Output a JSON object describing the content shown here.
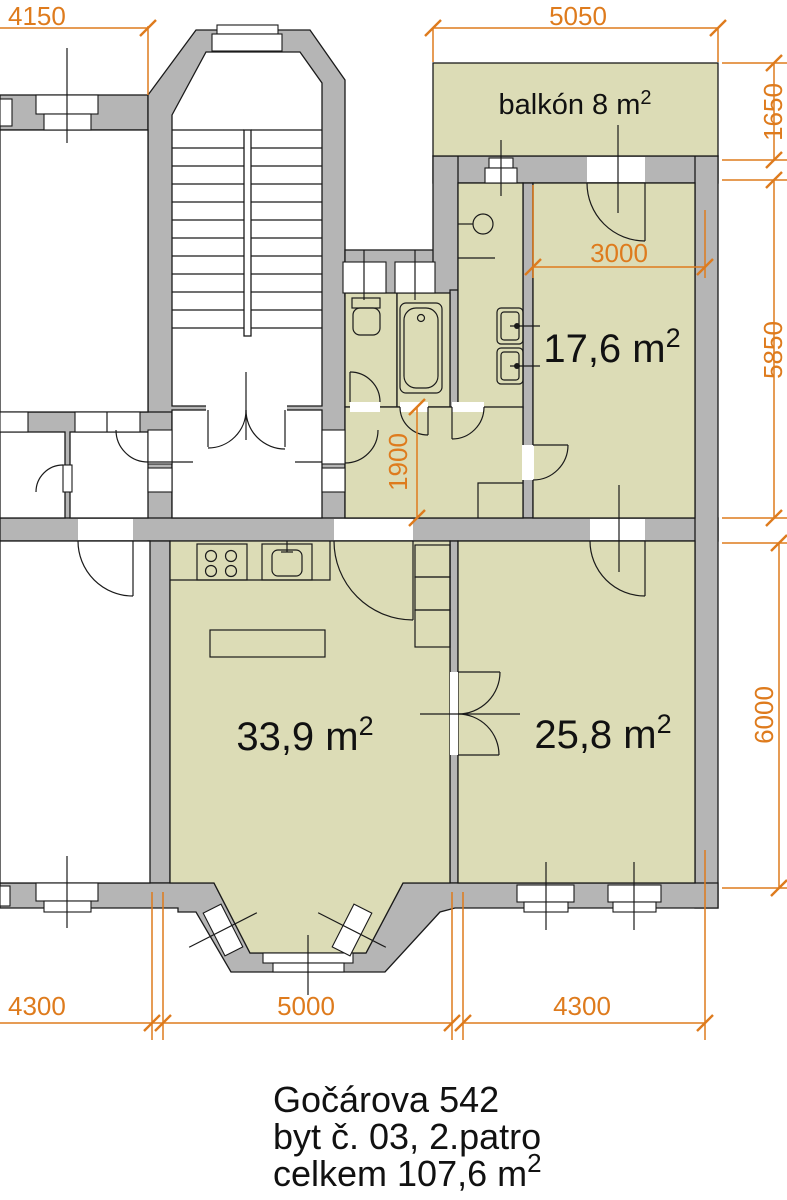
{
  "plan": {
    "type": "apartment-floor-plan",
    "labels": {
      "balcony": {
        "text": "balkón 8 m",
        "sup": "2"
      },
      "room_176": {
        "text": "17,6 m",
        "sup": "2"
      },
      "room_339": {
        "text": "33,9 m",
        "sup": "2"
      },
      "room_258": {
        "text": "25,8 m",
        "sup": "2"
      }
    },
    "dimensions": {
      "top_left": "4150",
      "top": "5050",
      "balcony_depth": "1650",
      "upper_section_height": "5850",
      "hall_height": "1900",
      "room_176_width": "3000",
      "lower_section_height": "6000",
      "bottom_left": "4300",
      "bottom_center": "5000",
      "bottom_right": "4300"
    },
    "title": {
      "line1": "Gočárova 542",
      "line2": "byt č. 03, 2.patro",
      "line3": "celkem 107,6 m",
      "line3_sup": "2"
    },
    "colors": {
      "room_fill": "#dcdcb6",
      "wall_fill": "#b5b5b5",
      "dimension_orange": "#de7b1d",
      "line_black": "#1a1a1a",
      "background": "#ffffff"
    }
  }
}
